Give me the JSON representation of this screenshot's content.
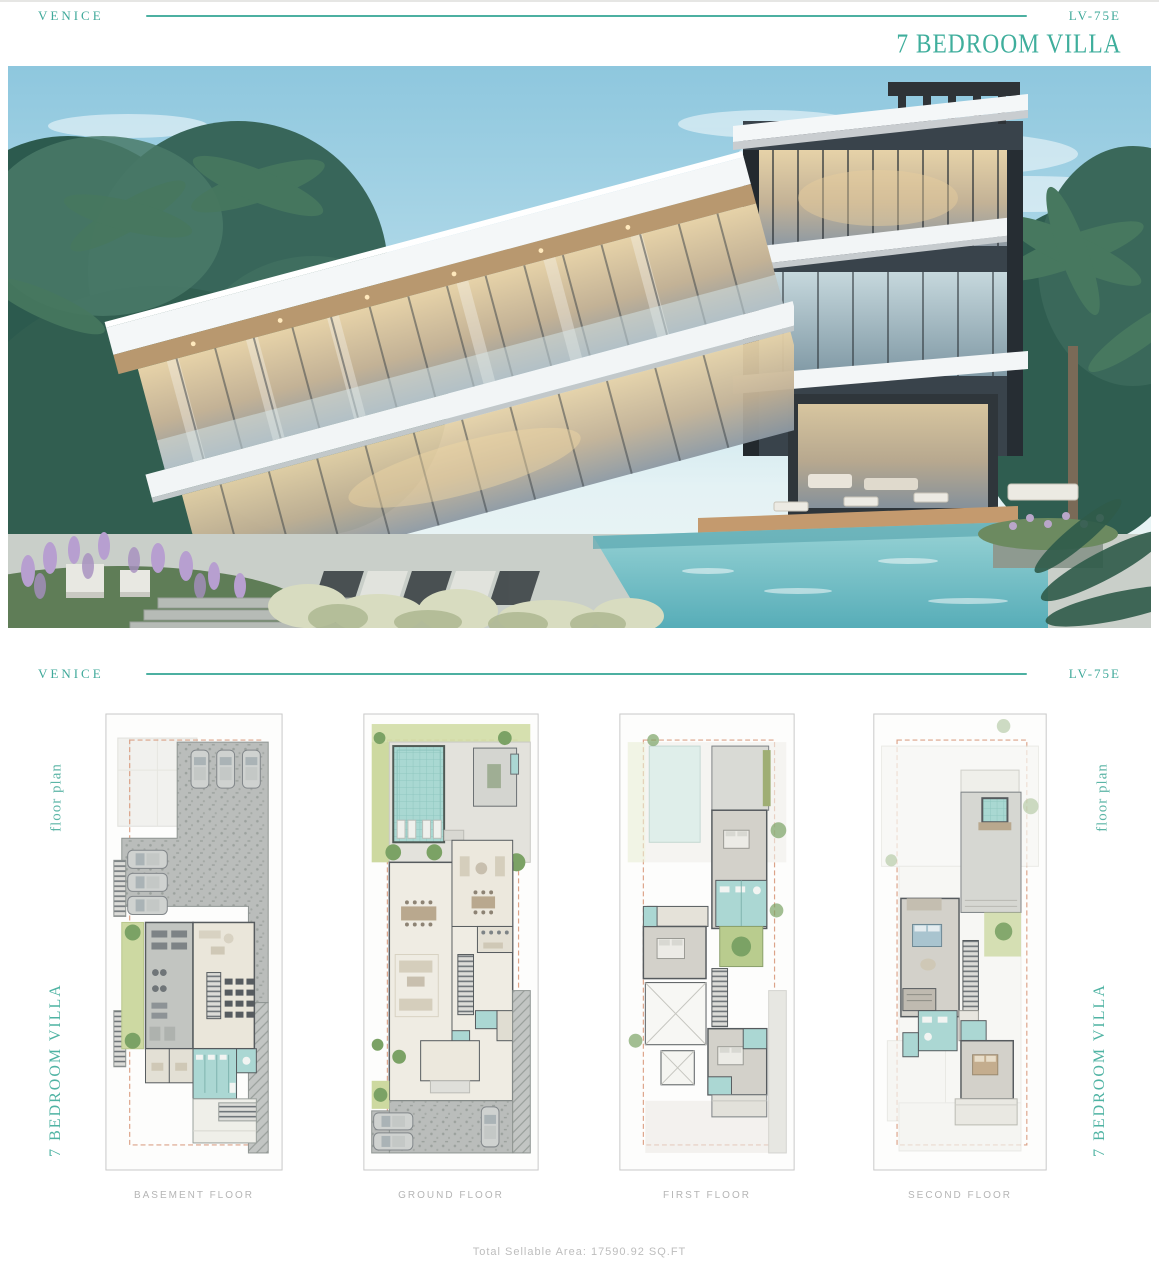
{
  "header_top": {
    "brand": "VENICE",
    "model": "LV-75E",
    "title": "7 BEDROOM VILLA"
  },
  "header_plans": {
    "brand": "VENICE",
    "model": "LV-75E"
  },
  "side_labels": {
    "left": {
      "script": "floor plan",
      "title": "7 BEDROOM VILLA"
    },
    "right": {
      "script": "floor plan",
      "title": "7 BEDROOM VILLA"
    }
  },
  "plans": [
    {
      "label": "BASEMENT FLOOR"
    },
    {
      "label": "GROUND FLOOR"
    },
    {
      "label": "FIRST FLOOR"
    },
    {
      "label": "SECOND FLOOR"
    }
  ],
  "footer": {
    "total_area": "Total Sellable Area: 17590.92 SQ.FT"
  },
  "colors": {
    "accent_teal": "#3FA99A",
    "accent_teal_light": "#5BB5A6",
    "caption_gray": "#B5B5B5",
    "plot_dashed_red": "#D8997C",
    "pool_teal": "#A9D8D2"
  }
}
